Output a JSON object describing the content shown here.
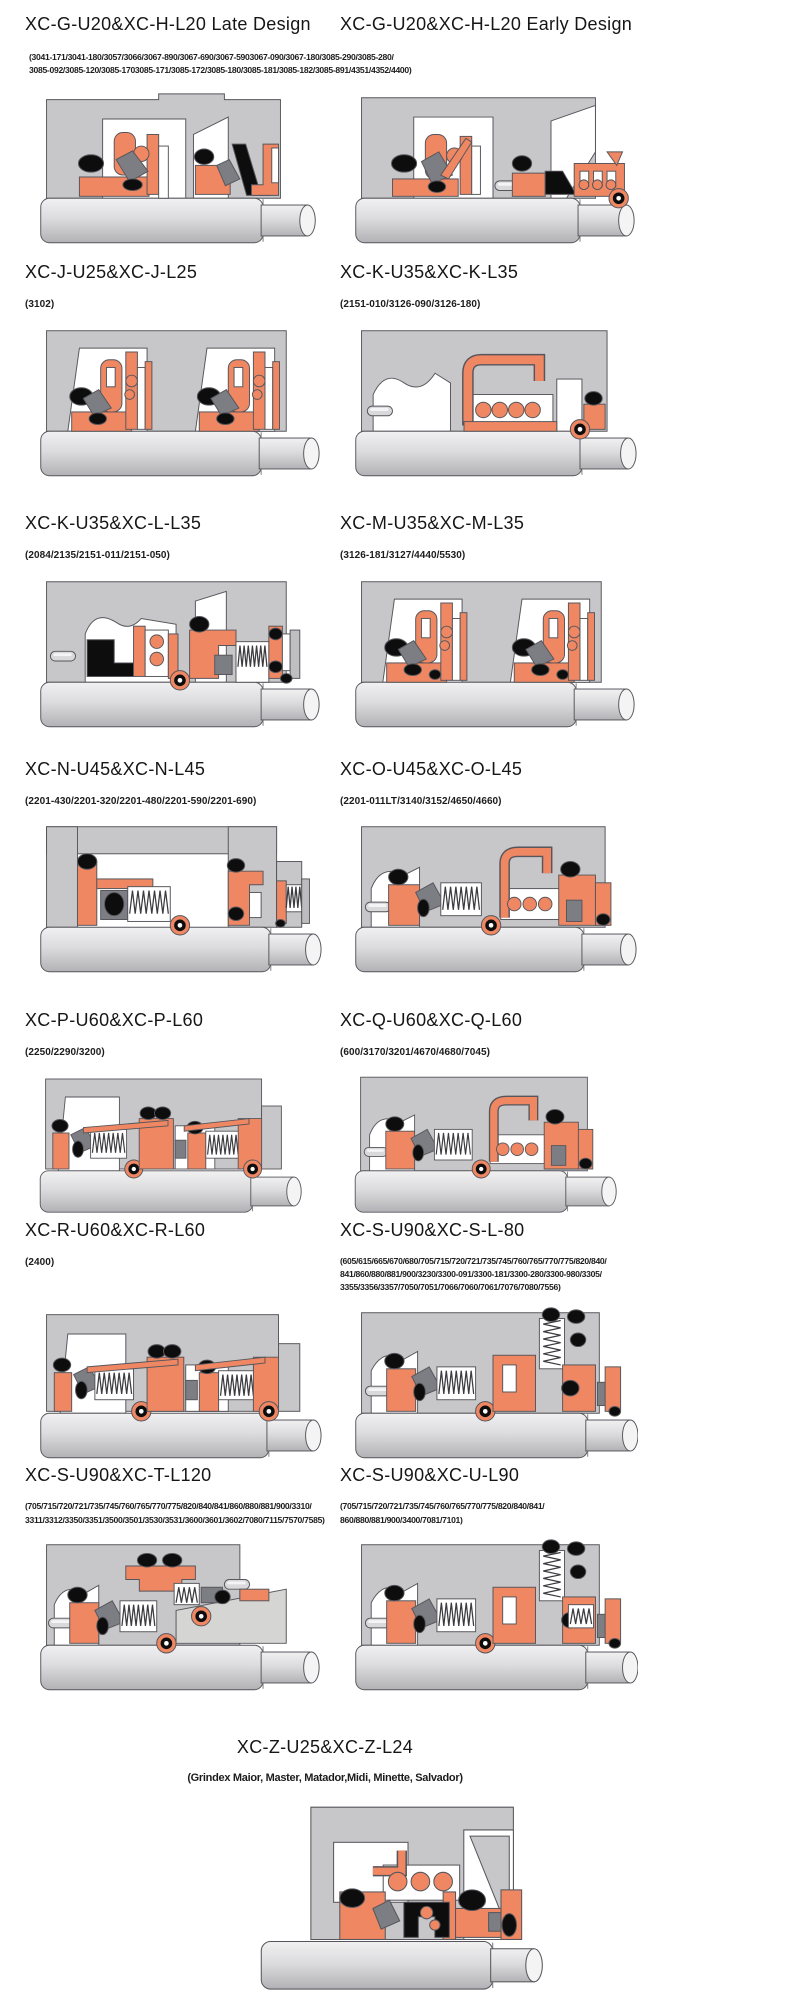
{
  "palette": {
    "housing": "#c7c7c9",
    "white": "#ffffff",
    "orange": "#ef8763",
    "dark": "#0d0d0d",
    "gray_part": "#7d7d84",
    "wedge_light": "#d5d5d3",
    "outline": "#56565c",
    "shaft_light": "#f1f1f2",
    "shaft_dark": "#b2b2b6"
  },
  "rows": [
    {
      "shared_parts": [
        "(3041-171/3041-180/3057/3066/3067-890/3067-690/3067-5903067-090/3067-180/3085-290/3085-280/",
        "3085-092/3085-120/3085-1703085-171/3085-172/3085-180/3085-181/3085-182/3085-891/4351/4352/4400)"
      ],
      "left": {
        "title": "XC-G-U20&XC-H-L20 Late Design",
        "variant": "dualA"
      },
      "right": {
        "title": "XC-G-U20&XC-H-L20 Early Design",
        "variant": "dualB"
      }
    },
    {
      "left": {
        "title": "XC-J-U25&XC-J-L25",
        "parts": [
          "(3102)"
        ],
        "variant": "twin"
      },
      "right": {
        "title": "XC-K-U35&XC-K-L35",
        "parts": [
          "(2151-010/3126-090/3126-180)"
        ],
        "variant": "coil"
      }
    },
    {
      "left": {
        "title": "XC-K-U35&XC-L-L35",
        "parts": [
          "(2084/2135/2151-011/2151-050)"
        ],
        "variant": "complex"
      },
      "right": {
        "title": "XC-M-U35&XC-M-L35",
        "parts": [
          "(3126-181/3127/4440/5530)"
        ],
        "variant": "twin2"
      }
    },
    {
      "left": {
        "title": "XC-N-U45&XC-N-L45",
        "parts": [
          "(2201-430/2201-320/2201-480/2201-590/2201-690)"
        ],
        "variant": "springFrame"
      },
      "right": {
        "title": "XC-O-U45&XC-O-L45",
        "parts": [
          "(2201-011LT/3140/3152/4650/4660)"
        ],
        "variant": "springCoil"
      }
    },
    {
      "left": {
        "title": "XC-P-U60&XC-P-L60",
        "parts": [
          "(2250/2290/3200)"
        ],
        "variant": "springDouble"
      },
      "right": {
        "title": "XC-Q-U60&XC-Q-L60",
        "parts": [
          "(600/3170/3201/4670/4680/7045)"
        ],
        "variant": "springCoil"
      }
    },
    {
      "left": {
        "title": "XC-R-U60&XC-R-L60",
        "parts": [
          "(2400)"
        ],
        "variant": "springDouble"
      },
      "right": {
        "title": "XC-S-U90&XC-S-L-80",
        "parts": [
          "(605/615/665/670/680/705/715/720/721/735/745/760/765/770/775/820/840/",
          "841/860/880/881/900/3230/3300-091/3300-181/3300-280/3300-980/3305/",
          "3355/3356/3357/7050/7051/7066/7060/7061/7076/7080/7556)"
        ],
        "variant": "springV"
      }
    },
    {
      "left": {
        "title": "XC-S-U90&XC-T-L120",
        "parts": [
          "(705/715/720/721/735/745/760/765/770/775/820/840/841/860/880/881/900/3310/",
          "3311/3312/3350/3351/3500/3501/3530/3531/3600/3601/3602/7080/7115/7570/7585)"
        ],
        "variant": "springWedge"
      },
      "right": {
        "title": "XC-S-U90&XC-U-L90",
        "parts": [
          "(705/715/720/721/735/745/760/765/770/775/820/840/841/",
          "860/880/881/900/3400/7081/7101)"
        ],
        "variant": "springV2"
      }
    },
    {
      "center": {
        "title": "XC-Z-U25&XC-Z-L24",
        "parts": [
          "(Grindex  Maior, Master, Matador,Midi, Minette, Salvador)"
        ],
        "variant": "grindex"
      }
    }
  ]
}
